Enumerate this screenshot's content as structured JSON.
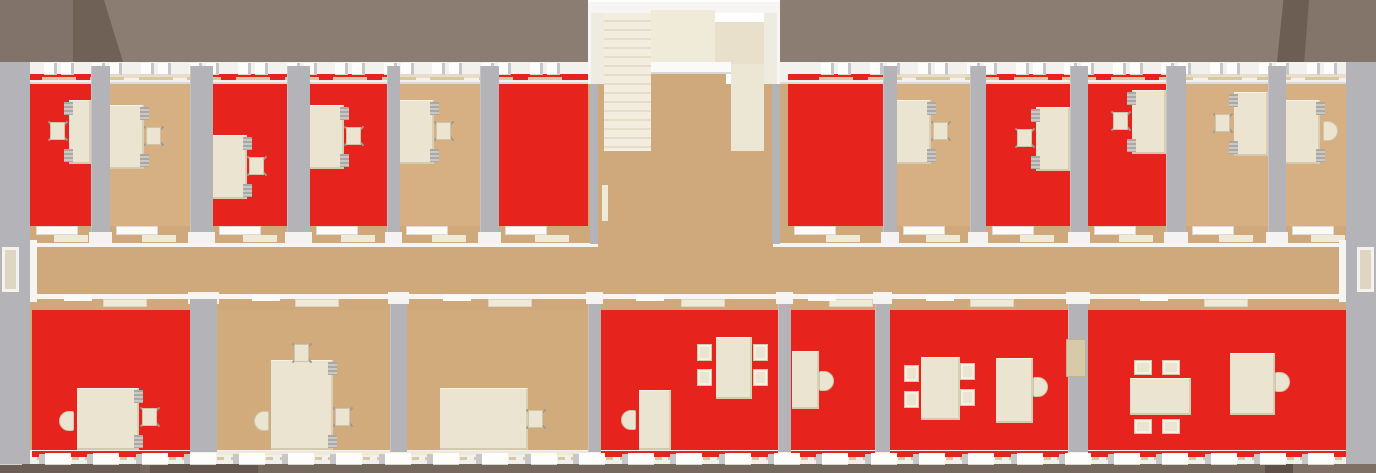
{
  "scene": {
    "width": 1376,
    "height": 473,
    "kind": "top-down office floorplan render"
  },
  "colors": {
    "red_floor": "#e6231d",
    "tan_office": "#d6b083",
    "tan_corridor": "#cfa87b",
    "tan_bottom": "#d2ab7d",
    "wall_gray": "#b4b3b8",
    "facade_white": "#f2f1ee",
    "facade_bottom": "#f1f0ed",
    "window_white": "#fdfdfc",
    "sill_tan": "#d9c79d",
    "cream_furniture": "#ebe4d1",
    "cream_wall": "#ece6d4",
    "stair_step_light": "#f2eddf",
    "stair_step_dark": "#e4ddc9",
    "panel_light": "#f0ead8",
    "panel_dark": "#e8e0ca",
    "roof_main": "#8c7d72",
    "roof_left": "#82736a",
    "roof_dark": "#6f6156",
    "roof_right_dark": "#6d5e54",
    "roof_right": "#84756a",
    "ground": "#75685d",
    "ground_dark1": "#6b5e54",
    "ground_dark2": "#64584e",
    "ground_dark3": "#5d5147",
    "ground_light": "#7e7064",
    "chair_gray": "#9b9a96",
    "accessory_gray": "#a9a8a4",
    "door_cream": "#efe9d7",
    "lintel_white": "#fafaf8"
  },
  "roof": {
    "bands": [
      {
        "x": 0,
        "w": 588,
        "color": "roof_main"
      },
      {
        "x": 780,
        "w": 596,
        "color": "roof_main"
      },
      {
        "x": 0,
        "w": 75,
        "color": "roof_left"
      },
      {
        "x": 1300,
        "w": 76,
        "color": "roof_right"
      }
    ],
    "facets": [
      {
        "x": 73,
        "w": 50,
        "color": "roof_dark",
        "clip": "polygon(0 0, 62% 0, 100% 100%, 0 100%)"
      },
      {
        "x": 1277,
        "w": 32,
        "color": "roof_right_dark",
        "clip": "polygon(20% 0, 100% 0, 85% 100%, 0 100%)"
      }
    ],
    "height": 62
  },
  "ground": {
    "y": 462,
    "h": 11,
    "segments": [
      {
        "x": 0,
        "w": 1376,
        "color": "ground"
      },
      {
        "x": 0,
        "w": 140,
        "color": "ground_dark1"
      },
      {
        "x": 150,
        "w": 108,
        "color": "ground_dark2"
      },
      {
        "x": 1265,
        "w": 28,
        "color": "ground_dark3"
      },
      {
        "x": 1293,
        "w": 83,
        "color": "ground_light"
      }
    ]
  },
  "top_row": {
    "floor_y": 84,
    "floor_h": 142,
    "wall_y": 66,
    "wall_h": 178,
    "rooms": [
      {
        "id": "office-1",
        "x": 30,
        "w": 61,
        "floor": "red",
        "desk": {
          "side": "right",
          "y": 100,
          "chair": "office",
          "desk_w": 22
        }
      },
      {
        "id": "office-2",
        "x": 110,
        "w": 80,
        "floor": "tan",
        "desk": {
          "side": "left",
          "y": 105,
          "chair": "office"
        }
      },
      {
        "id": "office-3",
        "x": 213,
        "w": 74,
        "floor": "red",
        "desk": {
          "side": "left",
          "y": 135,
          "chair": "office"
        }
      },
      {
        "id": "office-4",
        "x": 310,
        "w": 77,
        "floor": "red",
        "desk": {
          "side": "left",
          "y": 105,
          "chair": "office"
        }
      },
      {
        "id": "office-5",
        "x": 400,
        "w": 80,
        "floor": "tan",
        "desk": {
          "side": "left",
          "y": 100,
          "chair": "office"
        }
      },
      {
        "id": "office-6",
        "x": 499,
        "w": 89,
        "floor": "red",
        "desk": null
      },
      {
        "id": "office-7",
        "x": 788,
        "w": 95,
        "floor": "red",
        "desk": null
      },
      {
        "id": "office-8",
        "x": 897,
        "w": 73,
        "floor": "tan",
        "desk": {
          "side": "left",
          "y": 100,
          "chair": "office"
        }
      },
      {
        "id": "office-9",
        "x": 986,
        "w": 84,
        "floor": "red",
        "desk": {
          "side": "right",
          "y": 107,
          "chair": "office"
        }
      },
      {
        "id": "office-10",
        "x": 1088,
        "w": 78,
        "floor": "red",
        "desk": {
          "side": "right",
          "y": 90,
          "chair": "office"
        }
      },
      {
        "id": "office-11",
        "x": 1186,
        "w": 82,
        "floor": "tan",
        "desk": {
          "side": "right",
          "y": 92,
          "chair": "office"
        }
      },
      {
        "id": "office-12",
        "x": 1286,
        "w": 62,
        "floor": "tan",
        "desk": {
          "side": "left",
          "y": 100,
          "chair": "round"
        }
      }
    ]
  },
  "bottom_row": {
    "floor_y": 310,
    "floor_h": 142,
    "wall_y": 296,
    "wall_h": 156,
    "rooms": [
      {
        "id": "room-b1",
        "x": 32,
        "w": 158,
        "floor": "red",
        "items": [
          {
            "type": "table",
            "x": 77,
            "y": 388,
            "w": 62,
            "h": 62,
            "accessories": true
          },
          {
            "type": "round-chair",
            "x": 59,
            "y": 411,
            "dir": "left"
          },
          {
            "type": "office-chair",
            "x": 141,
            "y": 407
          }
        ]
      },
      {
        "id": "room-b2",
        "x": 217,
        "w": 173,
        "floor": "tan",
        "items": [
          {
            "type": "table",
            "x": 271,
            "y": 360,
            "w": 62,
            "h": 90,
            "accessories": true
          },
          {
            "type": "office-chair",
            "x": 293,
            "y": 343
          },
          {
            "type": "round-chair",
            "x": 254,
            "y": 411,
            "dir": "left"
          },
          {
            "type": "office-chair",
            "x": 334,
            "y": 407
          }
        ]
      },
      {
        "id": "room-b3",
        "x": 407,
        "w": 181,
        "floor": "tan",
        "items": [
          {
            "type": "table",
            "x": 440,
            "y": 388,
            "w": 88,
            "h": 62
          },
          {
            "type": "office-chair",
            "x": 527,
            "y": 409
          }
        ]
      },
      {
        "id": "room-b4",
        "x": 601,
        "w": 177,
        "floor": "red",
        "items": [
          {
            "type": "table",
            "x": 716,
            "y": 337,
            "w": 36,
            "h": 62
          },
          {
            "type": "side-chair",
            "x": 697,
            "y": 344
          },
          {
            "type": "side-chair",
            "x": 697,
            "y": 369
          },
          {
            "type": "side-chair",
            "x": 753,
            "y": 344
          },
          {
            "type": "side-chair",
            "x": 753,
            "y": 369
          },
          {
            "type": "desk",
            "x": 639,
            "y": 390,
            "w": 32,
            "h": 60
          },
          {
            "type": "round-chair",
            "x": 621,
            "y": 410,
            "dir": "left"
          }
        ]
      },
      {
        "id": "room-b5",
        "x": 791,
        "w": 84,
        "floor": "red",
        "items": [
          {
            "type": "desk",
            "x": 792,
            "y": 351,
            "w": 27,
            "h": 58
          },
          {
            "type": "round-chair",
            "x": 819,
            "y": 371,
            "dir": "right"
          }
        ]
      },
      {
        "id": "room-b6",
        "x": 890,
        "w": 178,
        "floor": "red",
        "items": [
          {
            "type": "table",
            "x": 921,
            "y": 357,
            "w": 39,
            "h": 63
          },
          {
            "type": "side-chair",
            "x": 904,
            "y": 365
          },
          {
            "type": "side-chair",
            "x": 904,
            "y": 391
          },
          {
            "type": "side-chair",
            "x": 960,
            "y": 363
          },
          {
            "type": "side-chair",
            "x": 960,
            "y": 389
          },
          {
            "type": "desk",
            "x": 996,
            "y": 358,
            "w": 37,
            "h": 65
          },
          {
            "type": "round-chair",
            "x": 1033,
            "y": 377,
            "dir": "right"
          },
          {
            "type": "cabinet",
            "x": 1066,
            "y": 339,
            "w": 20,
            "h": 38
          }
        ]
      },
      {
        "id": "room-b7",
        "x": 1088,
        "w": 258,
        "floor": "red",
        "items": [
          {
            "type": "table",
            "x": 1130,
            "y": 378,
            "w": 61,
            "h": 37
          },
          {
            "type": "side-chair",
            "x": 1134,
            "y": 360,
            "horiz": true
          },
          {
            "type": "side-chair",
            "x": 1162,
            "y": 360,
            "horiz": true
          },
          {
            "type": "side-chair",
            "x": 1134,
            "y": 419,
            "horiz": true
          },
          {
            "type": "side-chair",
            "x": 1162,
            "y": 419,
            "horiz": true
          },
          {
            "type": "desk",
            "x": 1230,
            "y": 353,
            "w": 45,
            "h": 62
          },
          {
            "type": "round-chair",
            "x": 1275,
            "y": 372,
            "dir": "right"
          }
        ]
      }
    ]
  },
  "corridor": {
    "x": 30,
    "w": 1316,
    "y": 226,
    "h": 84,
    "upper_line_y": 243,
    "lower_line_y": 294
  },
  "stairwell": {
    "x": 588,
    "y": 2,
    "w": 192,
    "h": 242,
    "top_wall": {
      "x": 0,
      "y": 0,
      "w": 192,
      "h": 11
    },
    "left_wall_white": {
      "x": 0,
      "y": 0,
      "w": 16,
      "h": 82
    },
    "right_wall_white": {
      "x": 176,
      "y": 0,
      "w": 16,
      "h": 82
    },
    "left_wall_gray": {
      "x": 2,
      "y": 82,
      "w": 8,
      "h": 160
    },
    "right_wall_gray": {
      "x": 184,
      "y": 82,
      "w": 8,
      "h": 160
    },
    "steps": {
      "x": 16,
      "y": 11,
      "w": 47,
      "h": 137
    },
    "panel_a": {
      "x": 63,
      "y": 8,
      "w": 64,
      "h": 56
    },
    "panel_b": {
      "x": 127,
      "y": 20,
      "w": 49,
      "h": 44
    },
    "lintel": {
      "x": 63,
      "y": 60,
      "w": 80,
      "h": 12
    },
    "landing": {
      "x": 63,
      "y": 72,
      "w": 75,
      "h": 80
    },
    "right_panel": {
      "x": 143,
      "y": 62,
      "w": 33,
      "h": 90
    },
    "lower_floor": {
      "x": 10,
      "y": 149,
      "w": 174,
      "h": 93
    },
    "door_leaf": {
      "x": 14,
      "y": 183,
      "w": 6,
      "h": 36
    }
  },
  "exterior": {
    "left_wall": {
      "x": 0,
      "w": 30
    },
    "right_wall": {
      "x": 1346,
      "w": 30
    },
    "wall_y": 62,
    "wall_h": 402,
    "left_door": {
      "x": 2,
      "y": 247,
      "w": 17,
      "h": 45
    },
    "left_jamb": {
      "x": 30,
      "y": 240,
      "w": 7,
      "h": 62
    },
    "right_door": {
      "x": 1357,
      "y": 247,
      "w": 17,
      "h": 45
    },
    "right_jamb": {
      "x": 1339,
      "y": 240,
      "w": 7,
      "h": 62
    }
  },
  "facade": {
    "top": {
      "y": 62,
      "h": 22,
      "spans": [
        {
          "x": 0,
          "w": 588
        },
        {
          "x": 780,
          "w": 596
        }
      ]
    },
    "bottom": {
      "y": 450,
      "h": 14,
      "spans": [
        {
          "x": 0,
          "w": 1376
        }
      ]
    },
    "windows_top": {
      "start": 10,
      "pitch": 48.6,
      "count": 28,
      "skip_from": 570,
      "skip_to": 800,
      "y": 63
    },
    "windows_bottom": {
      "start": 9,
      "pitch": 48.6,
      "count": 28,
      "y": 453
    }
  }
}
